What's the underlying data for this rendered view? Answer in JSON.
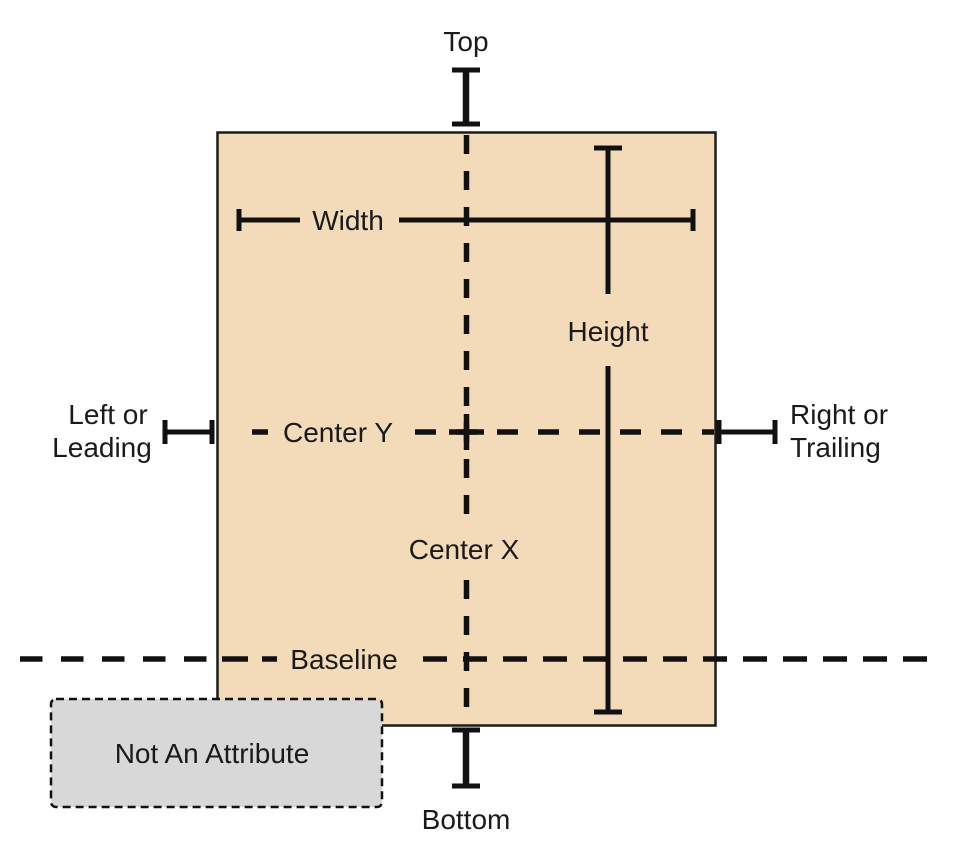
{
  "labels": {
    "top": "Top",
    "bottom": "Bottom",
    "width": "Width",
    "height": "Height",
    "center_x": "Center X",
    "center_y": "Center Y",
    "baseline": "Baseline",
    "left_leading": [
      "Left or",
      "Leading"
    ],
    "right_trailing": [
      "Right or",
      "Trailing"
    ],
    "not_an_attribute": "Not An Attribute"
  },
  "colors": {
    "background": "#ffffff",
    "view_fill": "#f3dab8",
    "view_border": "#1c1c1c",
    "line": "#111111",
    "text": "#1a1a1a",
    "not_attribute_fill": "#d8d8d8",
    "not_attribute_border": "#111111"
  }
}
